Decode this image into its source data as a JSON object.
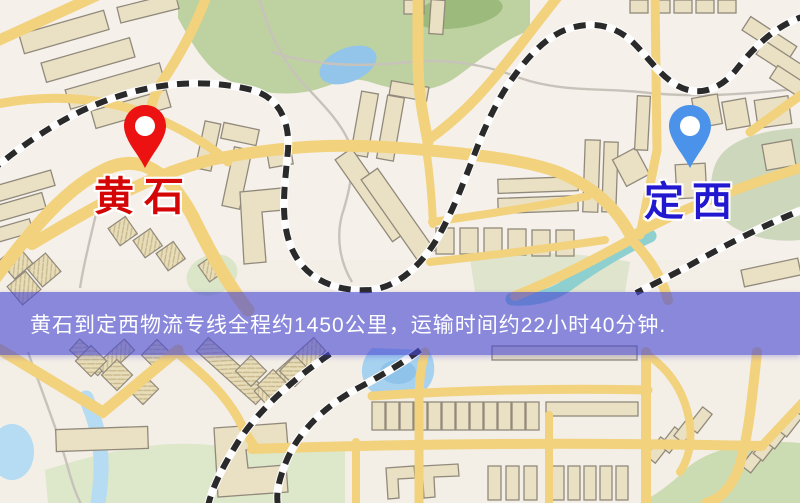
{
  "banner": {
    "text": "黄石到定西物流专线全程约1450公里，运输时间约22小时40分钟.",
    "background_color": "#4848d4",
    "text_color": "#ffffff"
  },
  "markers": [
    {
      "name": "黄石",
      "role": "origin",
      "pin_color": "#ec1212",
      "label_color": "#d40606"
    },
    {
      "name": "定西",
      "role": "destination",
      "pin_color": "#4b93ea",
      "label_color": "#2218d0"
    }
  ],
  "route_summary": {
    "origin": "黄石",
    "destination": "定西",
    "service": "物流专线",
    "distance_text": "约1450公里",
    "duration_text": "约22小时40分钟"
  },
  "map_palette": {
    "background": "#f3eee6",
    "road": "#f2d27d",
    "park": "#bdd2a0",
    "water": "#9cc8ee",
    "river": "#8ed0cf",
    "building": "#eae0c3",
    "railway": "#2a2a2a"
  }
}
